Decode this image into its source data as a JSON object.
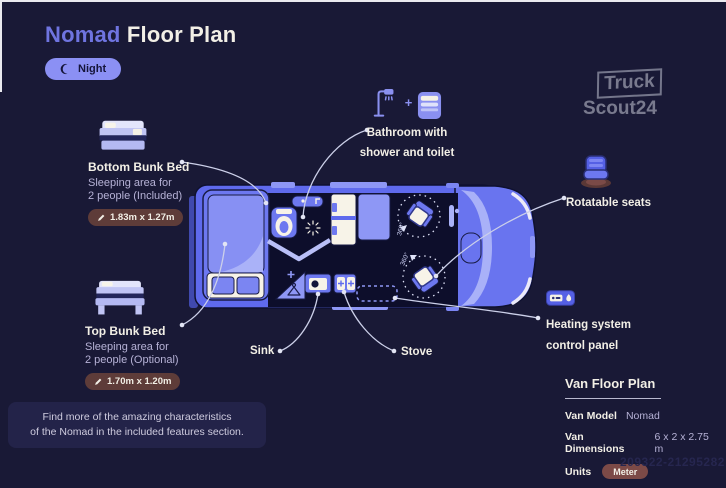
{
  "colors": {
    "background": "#191936",
    "accent_periwinkle": "#6f74e0",
    "van_blue": "#5f6aed",
    "van_light_blue": "#8e97f5",
    "interior_dark": "#0d0e2b",
    "cream": "#f7f3e8",
    "pill_maroon": "#5e3c39",
    "units_pill_maroon": "#7c4a47",
    "text_primary": "#f2efe6",
    "text_secondary": "#b6b2d6",
    "connector_line": "#ccd0e9",
    "night_pill_bg": "#8b90f4",
    "note_box_bg": "#232349"
  },
  "header": {
    "title_accent": "Nomad",
    "title_rest": "Floor Plan",
    "mode_label": "Night"
  },
  "brand": {
    "line1": "Truck",
    "line2": "Scout24"
  },
  "callouts": {
    "bathroom": {
      "line1": "Bathroom with",
      "line2": "shower and toilet",
      "plus": "+"
    },
    "bottom_bunk": {
      "title": "Bottom Bunk Bed",
      "desc1": "Sleeping area for",
      "desc2": "2 people (Included)",
      "dimensions": "1.83m x 1.27m"
    },
    "top_bunk": {
      "title": "Top Bunk Bed",
      "desc1": "Sleeping area for",
      "desc2": "2 people (Optional)",
      "dimensions": "1.70m x 1.20m"
    },
    "rotatable_seats": {
      "label": "Rotatable seats"
    },
    "heating": {
      "line1": "Heating system",
      "line2": "control panel"
    },
    "sink": {
      "label": "Sink"
    },
    "stove": {
      "label": "Stove"
    }
  },
  "floorplan": {
    "rotation_label": "360°"
  },
  "note": {
    "line1": "Find more of the amazing characteristics",
    "line2": "of the Nomad in the included features section."
  },
  "info_panel": {
    "title": "Van Floor Plan",
    "rows": [
      {
        "label": "Van Model",
        "value": "Nomad"
      },
      {
        "label": "Van Dimensions",
        "value": "6 x 2 x 2.75 m"
      },
      {
        "label": "Units",
        "value": "Meter"
      }
    ]
  },
  "watermark": "209322-21295282"
}
